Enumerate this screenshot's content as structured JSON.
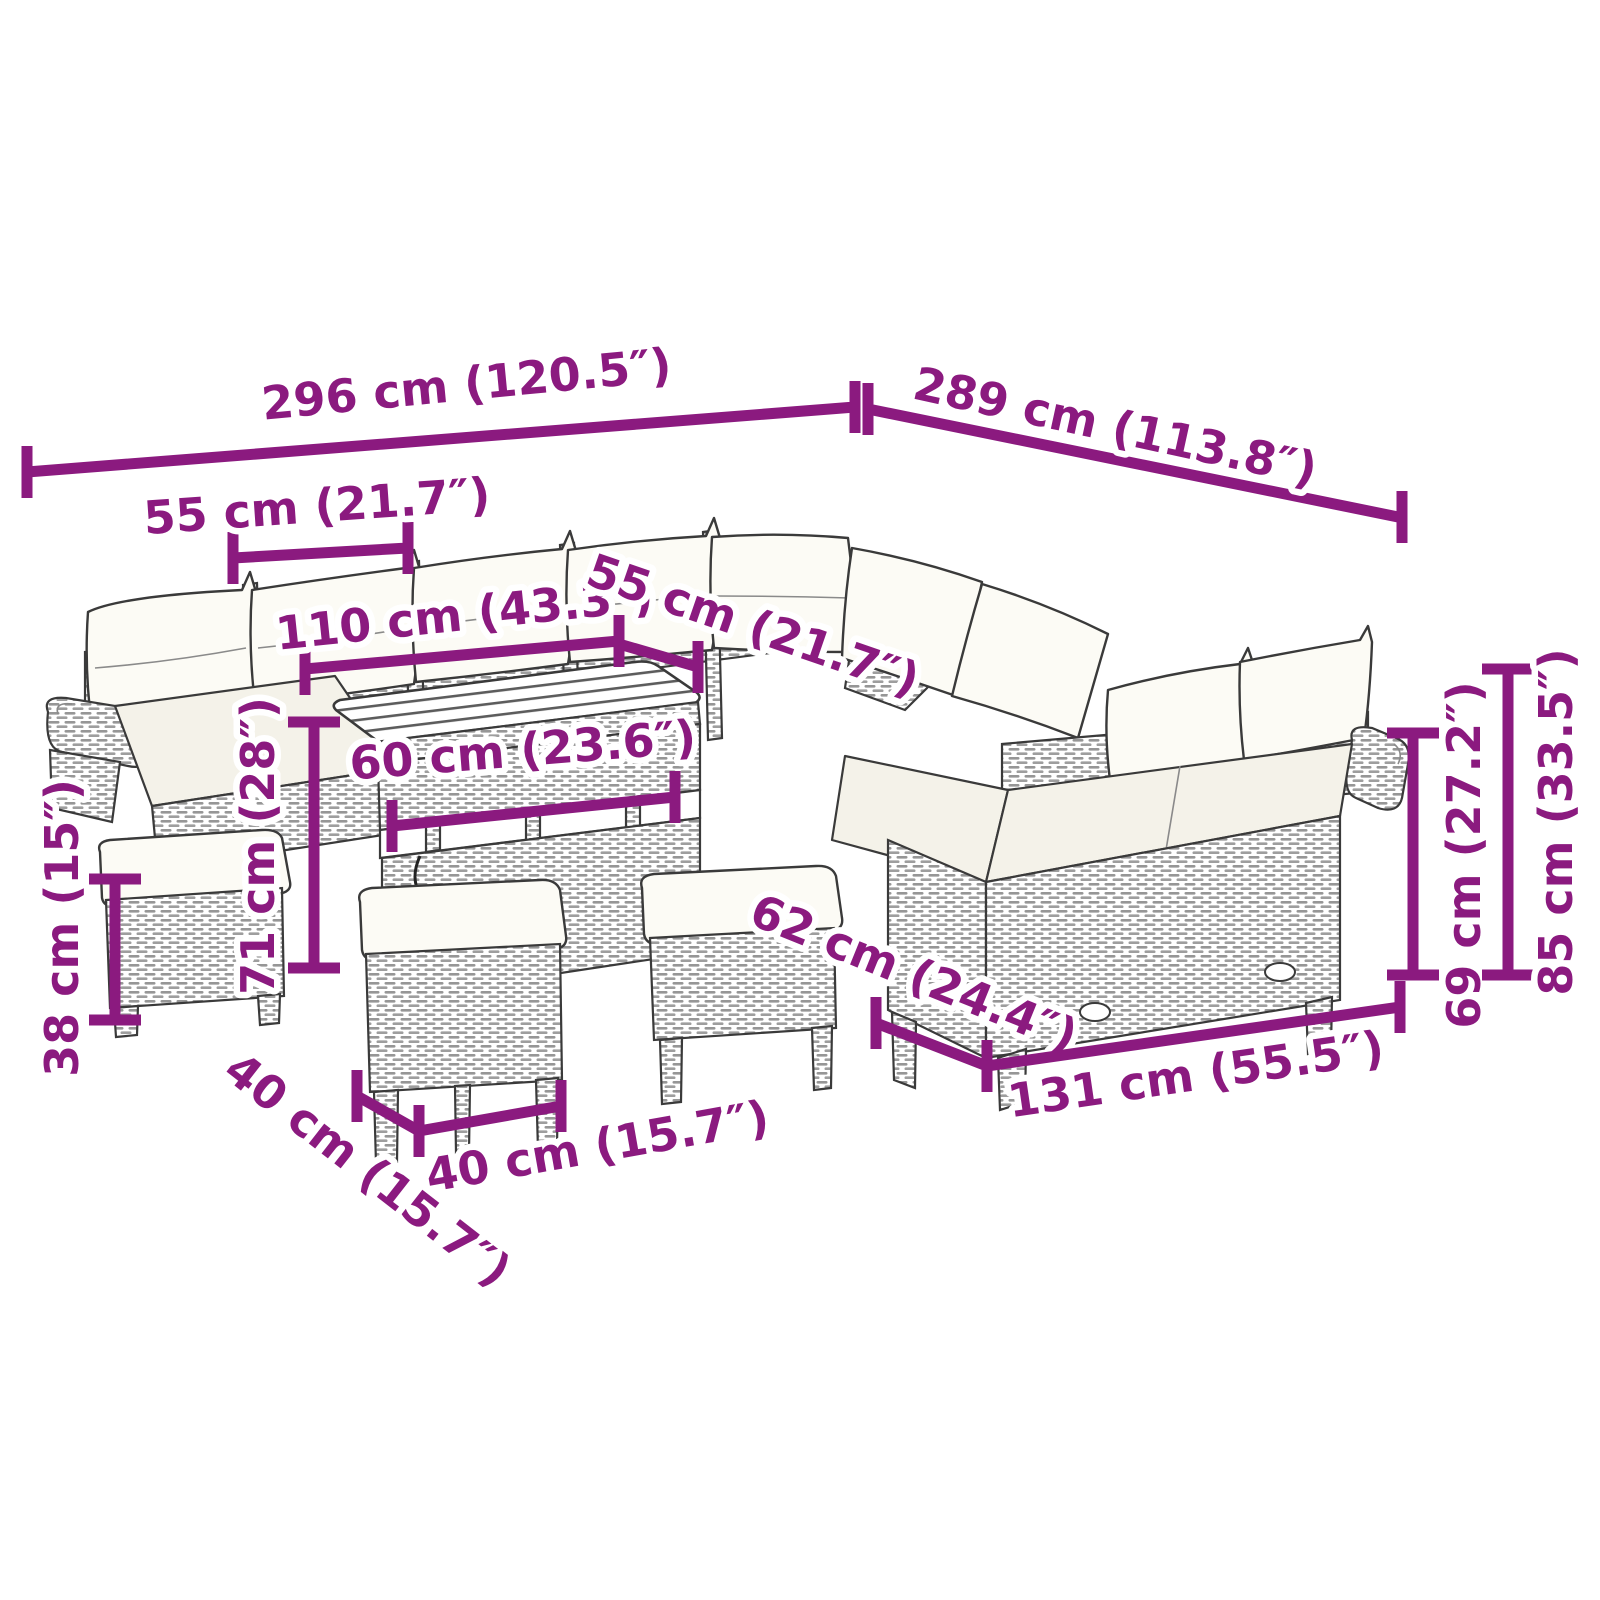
{
  "diagram": {
    "type": "product-dimension-diagram",
    "subject": "poly-rattan-garden-lounge-set-with-table-and-stools",
    "background": "#ffffff",
    "accent_color": "#8B1A7F",
    "line_color": "#3a3a3a",
    "cushion_color": "#fcfbf5"
  },
  "dimensions": [
    {
      "id": "overall-width",
      "label": "296 cm (120.5″)",
      "cm": 296,
      "inches": 120.5,
      "orientation": "slanted-horizontal"
    },
    {
      "id": "overall-depth",
      "label": "289 cm (113.8″)",
      "cm": 289,
      "inches": 113.8,
      "orientation": "slanted-horizontal"
    },
    {
      "id": "seat-width-back-left",
      "label": "55 cm (21.7″)",
      "cm": 55,
      "inches": 21.7,
      "orientation": "slanted-horizontal"
    },
    {
      "id": "table-length",
      "label": "110 cm (43.3″)",
      "cm": 110,
      "inches": 43.3,
      "orientation": "slanted-horizontal"
    },
    {
      "id": "seat-width-back-right",
      "label": "55 cm (21.7″)",
      "cm": 55,
      "inches": 21.7,
      "orientation": "diagonal"
    },
    {
      "id": "table-width",
      "label": "60 cm (23.6″)",
      "cm": 60,
      "inches": 23.6,
      "orientation": "slanted-horizontal"
    },
    {
      "id": "table-height",
      "label": "71 cm (28″)",
      "cm": 71,
      "inches": 28,
      "orientation": "vertical"
    },
    {
      "id": "stool-height",
      "label": "38 cm (15″)",
      "cm": 38,
      "inches": 15,
      "orientation": "vertical"
    },
    {
      "id": "stool-depth",
      "label": "40 cm (15.7″)",
      "cm": 40,
      "inches": 15.7,
      "orientation": "diagonal"
    },
    {
      "id": "stool-width",
      "label": "40 cm (15.7″)",
      "cm": 40,
      "inches": 15.7,
      "orientation": "slanted-horizontal"
    },
    {
      "id": "sofa-depth",
      "label": "62 cm (24.4″)",
      "cm": 62,
      "inches": 24.4,
      "orientation": "diagonal"
    },
    {
      "id": "sofa-section-length",
      "label": "131 cm (55.5″)",
      "cm": 131,
      "inches": 55.5,
      "orientation": "slanted-horizontal"
    },
    {
      "id": "armrest-height",
      "label": "69 cm (27.2″)",
      "cm": 69,
      "inches": 27.2,
      "orientation": "vertical"
    },
    {
      "id": "overall-height",
      "label": "85 cm (33.5″)",
      "cm": 85,
      "inches": 33.5,
      "orientation": "vertical"
    }
  ],
  "furniture_parts": [
    "back-sofa-row-with-cushions",
    "left-scroll-armrest",
    "corner-section",
    "right-sofa-row-with-cushions",
    "right-scroll-armrest",
    "slatted-top-storage-table",
    "stool-left-with-cushion",
    "stool-center-with-cushion",
    "stool-right-with-cushion"
  ]
}
